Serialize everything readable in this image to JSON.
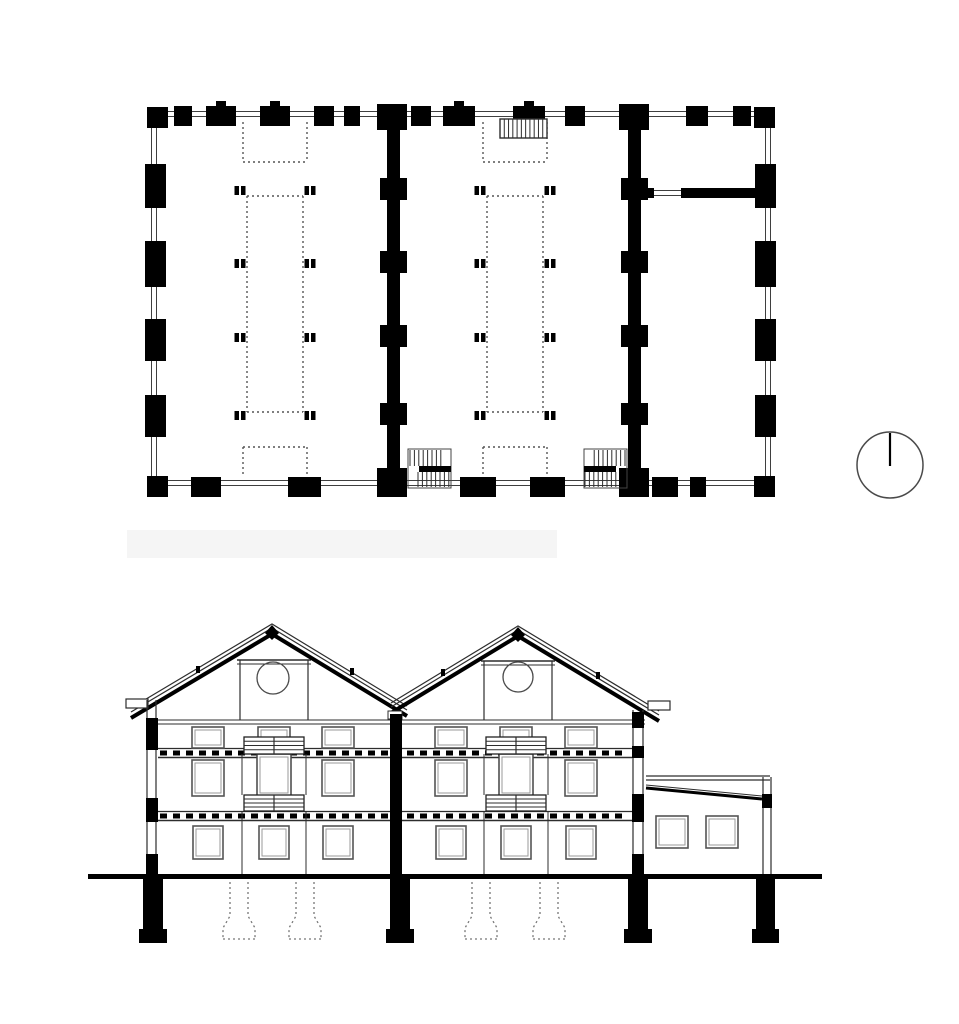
{
  "meta": {
    "sheet_name": "architectural-plan-and-section-drawing"
  },
  "colors": {
    "ink": "#000000",
    "line": "#3f3f3f",
    "thin": "#2d2d2d",
    "dotted": "#555555",
    "frame": "#555555",
    "frame_inner": "#9a9a9a",
    "gray_dotted": "#777777",
    "smudge": "#f5f5f5",
    "white": "#ffffff",
    "north_ring": "#4a4a4a"
  },
  "plan": {
    "ring_outer": {
      "x": 151.5,
      "y": 111.5,
      "w": 619,
      "h": 374
    },
    "ring_inner": {
      "x": 156.5,
      "y": 116.5,
      "w": 609,
      "h": 364
    },
    "corner_size": 21,
    "corners": [
      [
        147,
        107
      ],
      [
        754,
        107
      ],
      [
        147,
        476
      ],
      [
        754,
        476
      ]
    ],
    "top_piers": [
      [
        174,
        18
      ],
      [
        206,
        30
      ],
      [
        260,
        30
      ],
      [
        314,
        20
      ],
      [
        344,
        16
      ],
      [
        411,
        20
      ],
      [
        443,
        32
      ],
      [
        513,
        32
      ],
      [
        565,
        20
      ],
      [
        686,
        22
      ],
      [
        733,
        18
      ]
    ],
    "top_nubs": [
      221,
      275,
      459,
      529
    ],
    "bottom_piers": [
      [
        191,
        30
      ],
      [
        288,
        33
      ],
      [
        460,
        36
      ],
      [
        530,
        35
      ],
      [
        652,
        26
      ],
      [
        690,
        16
      ]
    ],
    "left_piers": [
      [
        164,
        44
      ],
      [
        241,
        46
      ],
      [
        319,
        42
      ],
      [
        395,
        42
      ]
    ],
    "right_piers": [
      [
        164,
        44
      ],
      [
        241,
        46
      ],
      [
        319,
        42
      ],
      [
        395,
        42
      ]
    ],
    "interior_walls": [
      387,
      628
    ],
    "interior_wall_w": 13,
    "wall_bump_rows": [
      178,
      251,
      325,
      403
    ],
    "junctions": [
      [
        377,
        104,
        30,
        26
      ],
      [
        377,
        468,
        30,
        29
      ],
      [
        619,
        104,
        30,
        26
      ],
      [
        619,
        468,
        30,
        29
      ]
    ],
    "partition": {
      "stub": [
        641,
        188,
        13,
        10
      ],
      "bar": [
        681,
        188,
        79,
        10
      ],
      "door_y": [
        190.5,
        195.5
      ],
      "door_x": [
        654,
        681
      ]
    },
    "columns": {
      "xs": [
        240,
        310,
        480,
        550
      ],
      "rows": [
        186,
        259,
        333,
        411
      ]
    },
    "dotted_bays": [
      275,
      515
    ],
    "dotted_top": {
      "hw": 32,
      "y1": 122,
      "y2": 162
    },
    "dotted_big": {
      "hw": 28,
      "y1": 196,
      "y2": 412
    },
    "dotted_bottom": {
      "hw": 32,
      "y1": 447,
      "y2": 477
    },
    "top_stair": {
      "x": 500,
      "y": 119,
      "w": 47,
      "h": 19,
      "lines": 10
    },
    "bottom_stairs": [
      {
        "x": 408,
        "flip": false
      },
      {
        "x": 584,
        "flip": true
      }
    ],
    "bottom_stair_size": {
      "y": 449,
      "w": 43,
      "h": 39
    }
  },
  "section": {
    "smudge": {
      "x": 127,
      "y": 530,
      "w": 430,
      "h": 28
    },
    "eaves": {
      "y": [
        720,
        724
      ],
      "span": [
        150,
        645
      ]
    },
    "gables": [
      {
        "apex": [
          272,
          624
        ],
        "left": [
          131,
          708
        ],
        "right": [
          407,
          706
        ],
        "attic": {
          "vx": [
            240,
            308
          ],
          "collar_y": 660,
          "circle": [
            273,
            678,
            16
          ]
        }
      },
      {
        "apex": [
          518,
          626
        ],
        "left": [
          391,
          703
        ],
        "right": [
          659,
          711
        ],
        "attic": {
          "vx": [
            484,
            552
          ],
          "collar_y": 661,
          "circle": [
            518,
            677,
            15
          ]
        }
      }
    ],
    "roof_layers": [
      [
        0,
        1.2
      ],
      [
        4,
        1.2
      ],
      [
        10,
        4
      ]
    ],
    "valley_box": [
      388,
      711,
      14,
      8
    ],
    "gutters": [
      [
        126,
        699,
        22,
        9
      ],
      [
        648,
        701,
        22,
        9
      ]
    ],
    "cleats": [
      [
        196,
        666
      ],
      [
        350,
        668
      ],
      [
        441,
        669
      ],
      [
        596,
        672
      ]
    ],
    "floor_bands": [
      {
        "y": 748,
        "h": 9
      },
      {
        "y": 811,
        "h": 9
      }
    ],
    "band_span": [
      158,
      632
    ],
    "joist": {
      "w": 7,
      "h": 5,
      "step": 13
    },
    "bays": [
      {
        "cols": [
          208,
          274,
          338
        ],
        "cx": 274
      },
      {
        "cols": [
          451,
          516,
          581
        ],
        "cx": 516
      }
    ],
    "rows": {
      "A": {
        "y": 727,
        "h": 21,
        "w": 32
      },
      "B": {
        "y": 760,
        "h": 36,
        "w": 32
      },
      "C": {
        "y": 826,
        "h": 33,
        "w": 30
      }
    },
    "stair": {
      "band1_y": 737,
      "band1_h": 17,
      "band2_y": 795,
      "band2_h": 16,
      "hw": 30,
      "door": {
        "y": 754,
        "h": 42,
        "hw": 17
      },
      "jamb_dx": 32,
      "jambB": [
        754,
        795
      ],
      "jambC": [
        811,
        874
      ]
    },
    "walls": {
      "left": {
        "fill_x": 146,
        "w": 12,
        "lines": [
          147,
          156
        ],
        "top": 700,
        "bottom": 877,
        "fills": [
          [
            718,
            32
          ],
          [
            798,
            24
          ],
          [
            854,
            23
          ]
        ]
      },
      "interior": {
        "x": 390,
        "w": 12,
        "top": 714,
        "bottom": 878
      },
      "right": {
        "fill_x": 632,
        "w": 12,
        "lines": [
          633,
          643
        ],
        "top": 710,
        "bottom": 877,
        "fills": [
          [
            712,
            16
          ],
          [
            746,
            12
          ],
          [
            794,
            28
          ],
          [
            854,
            23
          ]
        ]
      },
      "annex_right": {
        "fill_x": 762,
        "w": 10,
        "lines": [
          763,
          771
        ],
        "top": 777,
        "bottom": 875,
        "fills": [
          [
            794,
            14
          ]
        ]
      }
    },
    "annex": {
      "top_lines_y": [
        776,
        780
      ],
      "span": [
        646,
        770
      ],
      "slope_thin": [
        646,
        785,
        762,
        796
      ],
      "slope_thick": [
        646,
        788,
        762,
        799
      ],
      "windows": [
        [
          656,
          816,
          32,
          32
        ],
        [
          706,
          816,
          32,
          32
        ]
      ]
    },
    "ground": {
      "x": 88,
      "y": 874,
      "w": 734,
      "h": 5
    },
    "foundations": {
      "pier_y": 879,
      "pier_h": 50,
      "footing_h": 14,
      "footing_dx": 4,
      "piers": [
        [
          143,
          20
        ],
        [
          390,
          20
        ],
        [
          628,
          20
        ],
        [
          756,
          19
        ]
      ],
      "dotted_cx": [
        239,
        305,
        481,
        549
      ],
      "dotted_shape": {
        "half_shaft": 9,
        "half_base": 16,
        "shaft_top": 882,
        "flare_y": 916,
        "base_y": 928,
        "bottom_y": 939
      }
    }
  },
  "north_symbol": {
    "cx": 890,
    "cy": 465,
    "r": 33
  }
}
